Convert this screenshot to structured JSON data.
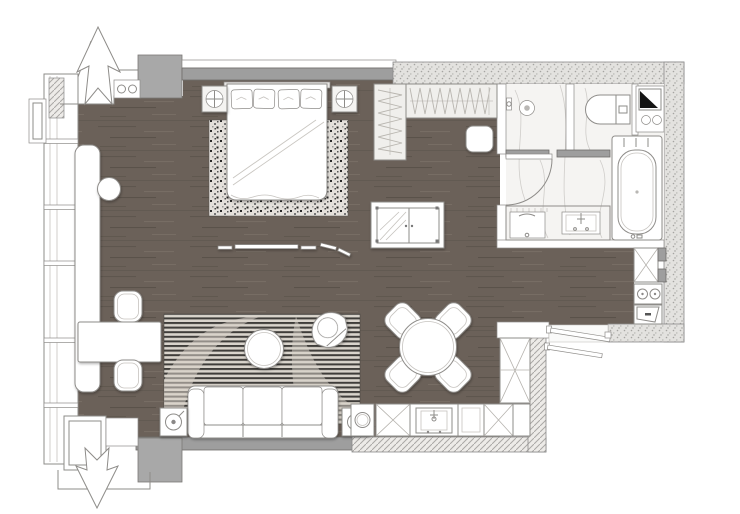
{
  "meta": {
    "description": "Top-down architectural floor plan of a studio apartment with bedroom area, wardrobe, bathroom, kitchen, dining set and living area",
    "figure_type": "floor-plan"
  },
  "colors": {
    "background": "#ffffff",
    "floor_wood": "#6b6159",
    "wall_gray": "#9e9e9e",
    "column_gray": "#a8a8a8",
    "stipple_bg": "#e3e2df",
    "stipple_dot": "#a5a4a1",
    "hatch_bg": "#edebe8",
    "hatch_line": "#aaa8a5",
    "marble": "#f5f4f2",
    "marble_vein": "#d9d6d2",
    "outline": "#8e8c89",
    "speckle_bg": "#e8e5e0",
    "stripe_light": "#d9d4cc",
    "stripe_dark": "#3f3d3a",
    "triangle_black": "#141414"
  },
  "legend": {
    "window-wall": "floor-to-ceiling window wall with mullions",
    "entry-arrow": "direction arrow through facade",
    "double-bed": "double bed with four pillows and folded blanket",
    "bed-rug": "speckled area rug under bed",
    "nightstand": "nightstand with round table lamp",
    "wardrobe": "open wardrobe with clothes hangers",
    "ottoman": "square ottoman",
    "bench-rods": "slim low bench",
    "tv-cabinet": "media cabinet with glass door",
    "window-desk": "long desk along window wall",
    "desk-stool": "round stool",
    "side-table": "work table with two barrel chairs",
    "living-rug": "striped rug with curved motif",
    "coffee-table": "round coffee table",
    "armchair": "shell armchair",
    "sofa": "three-seat sofa with two armrests",
    "lamp-table": "end table with lamp",
    "dining-table": "round dining table",
    "dining-chair": "dining chair set diagonally",
    "kitchen-counter": "L-shaped kitchen counter with cross-marked cabinets",
    "kitchen-sink": "kitchen sink with faucet",
    "cooktop": "two-burner cooktop",
    "oven": "oven with tilted door",
    "tall-cabinet": "tall cross-marked cabinet",
    "entry-door": "entry door leaves",
    "shower": "walk-in shower with rain head",
    "toilet": "toilet with tank",
    "bathtub": "built-in bathtub with deck",
    "vanity": "bathroom vanity with cabinet and sink",
    "utility-unit": "corner utility unit with shaft triangle and two knobs"
  }
}
